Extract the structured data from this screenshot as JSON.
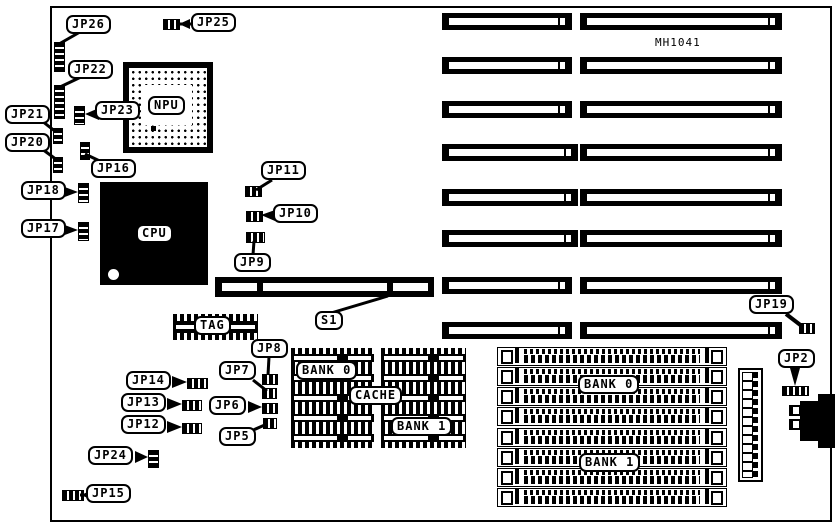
{
  "board": {
    "model": "MH1041"
  },
  "chips": {
    "cpu": "CPU",
    "npu": "NPU"
  },
  "switch_block": {
    "s1": "S1"
  },
  "tag": {
    "label": "TAG"
  },
  "cache": {
    "bank0": "BANK 0",
    "label": "CACHE",
    "bank1": "BANK 1"
  },
  "simm": {
    "bank0": "BANK 0",
    "bank1": "BANK 1"
  },
  "jumpers": {
    "jp2": "JP2",
    "jp5": "JP5",
    "jp6": "JP6",
    "jp7": "JP7",
    "jp8": "JP8",
    "jp9": "JP9",
    "jp10": "JP10",
    "jp11": "JP11",
    "jp12": "JP12",
    "jp13": "JP13",
    "jp14": "JP14",
    "jp15": "JP15",
    "jp16": "JP16",
    "jp17": "JP17",
    "jp18": "JP18",
    "jp19": "JP19",
    "jp20": "JP20",
    "jp21": "JP21",
    "jp22": "JP22",
    "jp23": "JP23",
    "jp24": "JP24",
    "jp25": "JP25",
    "jp26": "JP26"
  },
  "colors": {
    "ink": "#000000",
    "paper": "#ffffff"
  }
}
